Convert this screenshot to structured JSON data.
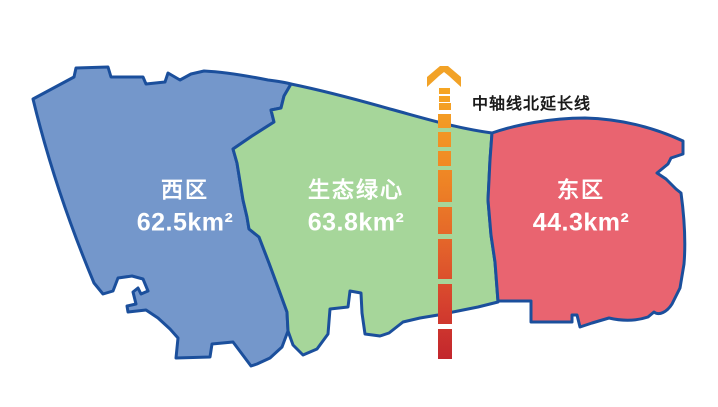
{
  "regions": [
    {
      "id": "west",
      "name": "西区",
      "area": "62.5km²",
      "fill": "#7497CB"
    },
    {
      "id": "green-heart",
      "name": "生态绿心",
      "area": "63.8km²",
      "fill": "#A6D69A"
    },
    {
      "id": "east",
      "name": "东区",
      "area": "44.3km²",
      "fill": "#E96470"
    }
  ],
  "axis": {
    "label": "中轴线北延长线",
    "arrow_color": "#F2A227",
    "gradient_top": "#F6A623",
    "gradient_bottom": "#C2262D"
  },
  "outline_color": "#1B4F9C",
  "background_color": "#FFFFFF"
}
